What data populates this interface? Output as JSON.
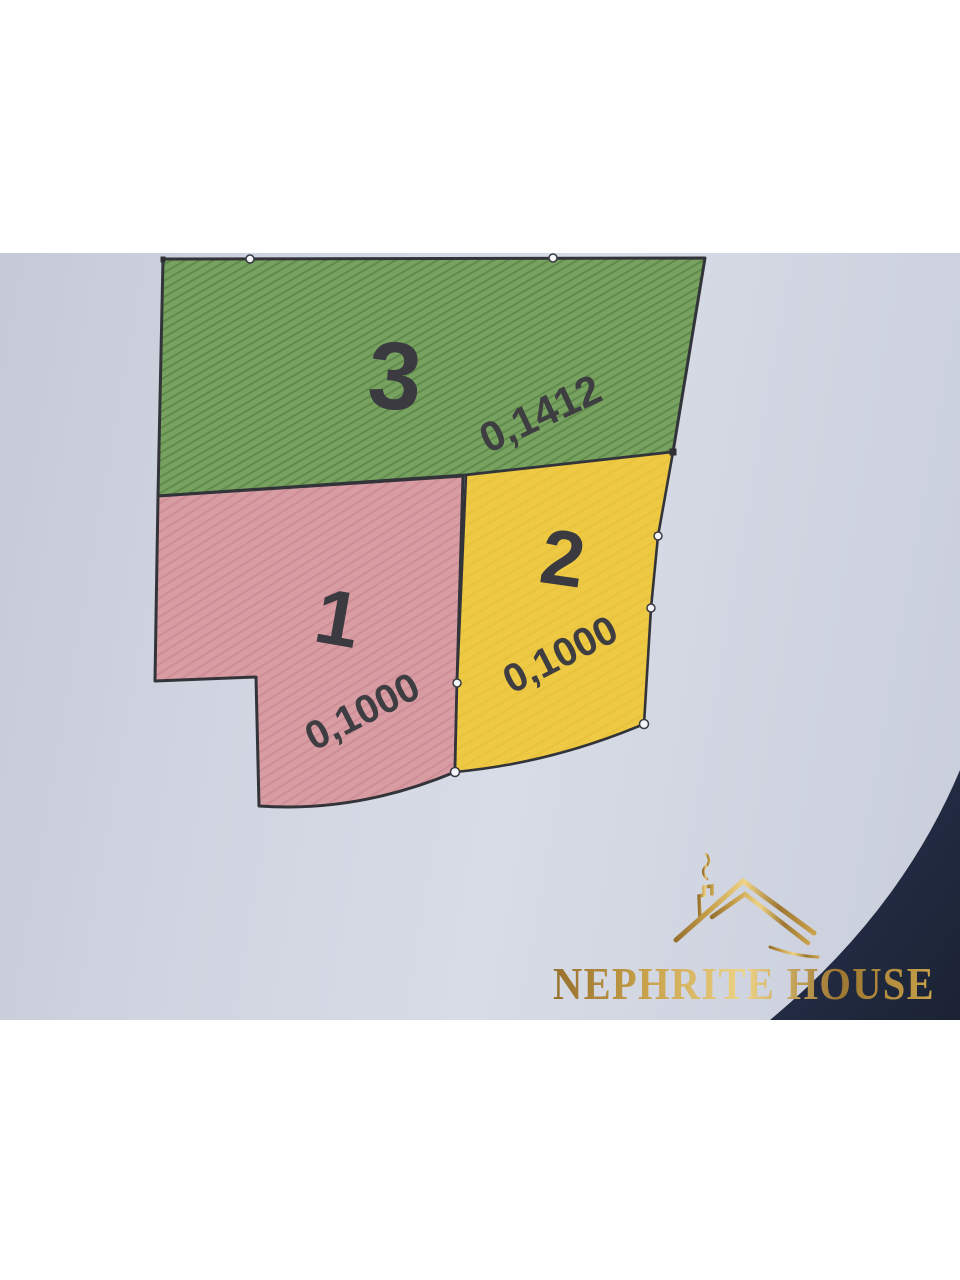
{
  "photo": {
    "kind": "cadastral-parcel-plan-photo",
    "paper_color": "#ccd1dd",
    "corner_shadow_color": "#222b40",
    "boundary_color": "#33343a",
    "label_color": "#3a3a40",
    "parcels": [
      {
        "number": "3",
        "area": "0,1412",
        "fill": "#78a25f",
        "hatch": "diagonal"
      },
      {
        "number": "1",
        "area": "0,1000",
        "fill": "#d89da3",
        "hatch": "diagonal"
      },
      {
        "number": "2",
        "area": "0,1000",
        "fill": "#edc944",
        "hatch": "none"
      }
    ],
    "watermark": {
      "brand": "NEPHRITE HOUSE",
      "gold": "#c9a24a",
      "icon": "roof-chimney-smoke-icon"
    }
  }
}
